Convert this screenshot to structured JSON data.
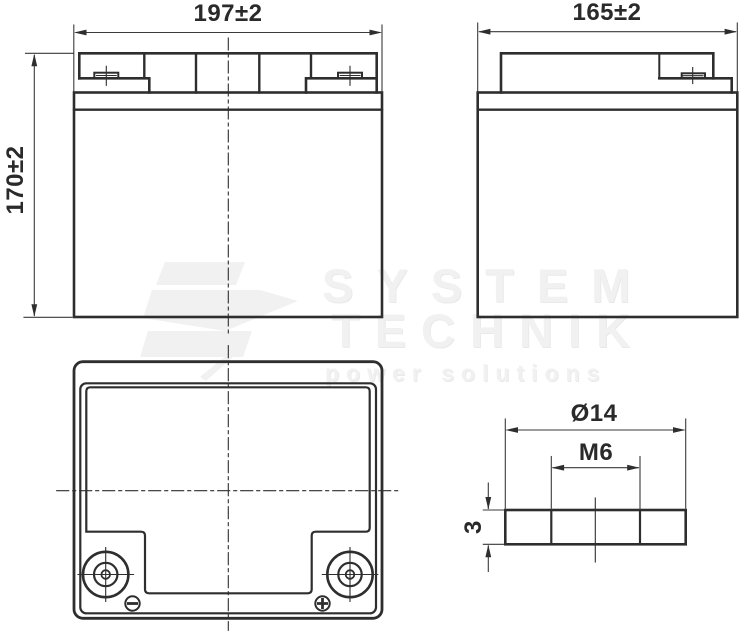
{
  "document": {
    "type": "technical-drawing",
    "subject": "battery outline dimensions"
  },
  "colors": {
    "line": "#2e2e2e",
    "dim_line": "#3a3a3a",
    "background": "#ffffff",
    "watermark": "#f1f1f1"
  },
  "dimensions": {
    "front_width": "197±2",
    "overall_height": "170±2",
    "side_depth": "165±2",
    "terminal_diameter": "Ø14",
    "terminal_thread": "M6",
    "terminal_thickness": "3"
  },
  "symbols": {
    "negative": "−",
    "positive": "+"
  },
  "watermark": {
    "line1": "SYSTEM",
    "line2": "TECHNIK",
    "tagline": "power solutions"
  }
}
